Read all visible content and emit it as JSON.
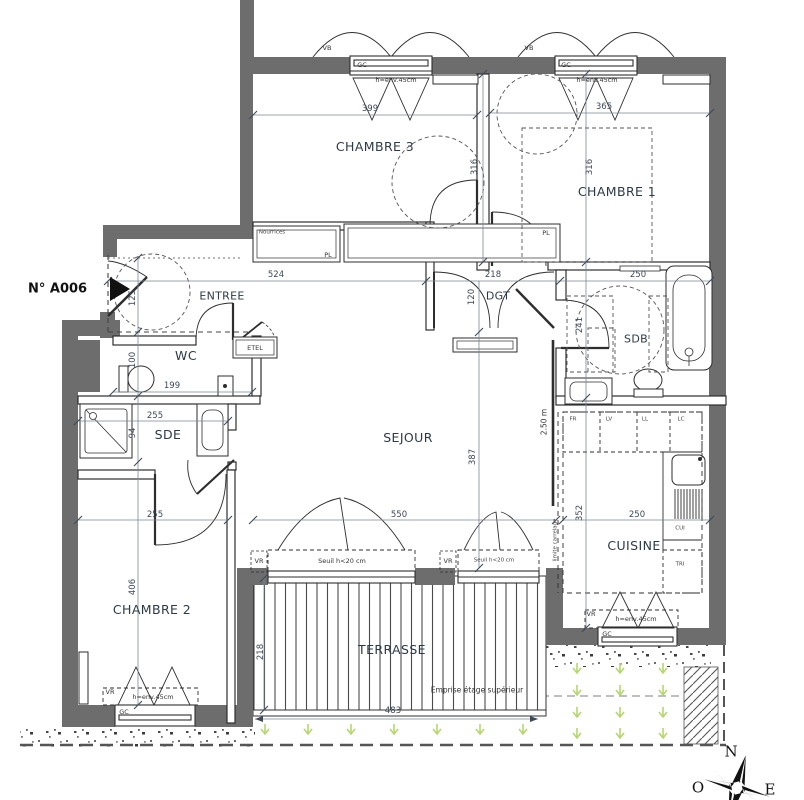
{
  "marker": {
    "label": "N° A006"
  },
  "rooms": {
    "chambre3": "CHAMBRE 3",
    "chambre1": "CHAMBRE 1",
    "entree": "ENTREE",
    "dgt": "DGT",
    "wc": "WC",
    "sde": "SDE",
    "sdb": "SDB",
    "sejour": "SEJOUR",
    "cuisine": "CUISINE",
    "chambre2": "CHAMBRE 2",
    "terrasse": "TERRASSE"
  },
  "dimensions": {
    "chambre3_width": "399",
    "chambre1_width": "365",
    "chambre3_depth": "316",
    "chambre1_depth": "316",
    "hall_length": "524",
    "dgt_width": "218",
    "sdb_width": "250",
    "dgt_depth": "120",
    "entry_width": "125",
    "wc_depth": "100",
    "wc_width": "199",
    "sde_width": "255",
    "sde_depth": "94",
    "chambre2_width": "255",
    "chambre2_depth": "406",
    "sejour_depth": "387",
    "sejour_width": "550",
    "cuisine_depth": "352",
    "cuisine_width": "250",
    "sdb_depth": "241",
    "terrasse_depth": "218",
    "terrasse_width": "483"
  },
  "windows": {
    "vb": "VB",
    "gc": "GC",
    "vr": "VR",
    "height_note": "h=env.45cm",
    "seuil_note": "Seuil h<20 cm"
  },
  "closets": {
    "nourrices": "Nourrices",
    "pl": "PL",
    "etel": "ETEL"
  },
  "kitchen_units": {
    "fr": "FR",
    "lv": "LV",
    "ll": "LL",
    "lc": "LC",
    "cui": "CUI",
    "tri": "TRI"
  },
  "annotations": {
    "ceiling_height": "2.50 m",
    "tile_limit": "limite carrelage",
    "upper_floor": "Emprise étage supérieur"
  },
  "compass": {
    "north": "N",
    "west": "O",
    "east": "E"
  },
  "colors": {
    "wall": "#6d6d6d",
    "line": "#2e2e2e",
    "green": "#b5d76e"
  }
}
